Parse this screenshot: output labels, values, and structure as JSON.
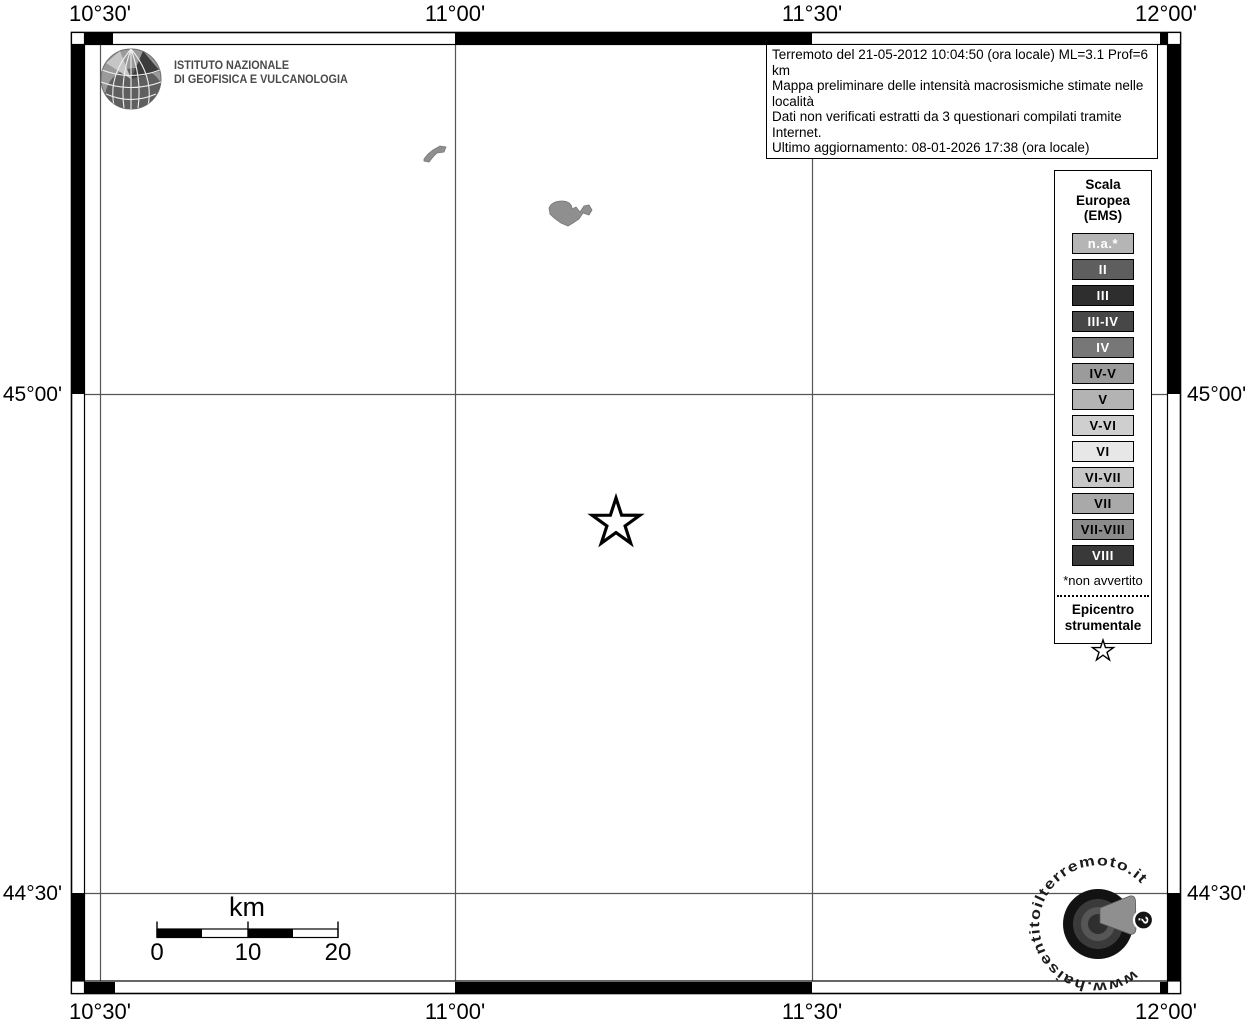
{
  "frame": {
    "top_labels": [
      "10°30'",
      "11°00'",
      "11°30'",
      "12°00'"
    ],
    "bottom_labels": [
      "10°30'",
      "11°00'",
      "11°30'",
      "12°00'"
    ],
    "left_labels": [
      "45°00'",
      "44°30'"
    ],
    "right_labels": [
      "45°00'",
      "44°30'"
    ]
  },
  "header": {
    "ingv_line1": "ISTITUTO NAZIONALE",
    "ingv_line2": "DI GEOFISICA E VULCANOLOGIA"
  },
  "info_box": {
    "line1": "Terremoto del 21-05-2012 10:04:50 (ora locale) ML=3.1 Prof=6 km",
    "line2": "Mappa preliminare delle intensità macrosismiche stimate nelle località",
    "line3": "Dati non verificati estratti da 3 questionari compilati tramite Internet.",
    "line4": "Ultimo aggiornamento: 08-01-2026 17:38 (ora locale)"
  },
  "legend": {
    "title_line1": "Scala",
    "title_line2": "Europea",
    "title_line3": "(EMS)",
    "items": [
      {
        "label": "n.a.*",
        "bg": "#b5b5b5",
        "fg": "#ffffff"
      },
      {
        "label": "II",
        "bg": "#5e5e5e",
        "fg": "#ffffff"
      },
      {
        "label": "III",
        "bg": "#2e2e2e",
        "fg": "#ffffff"
      },
      {
        "label": "III-IV",
        "bg": "#474747",
        "fg": "#ffffff"
      },
      {
        "label": "IV",
        "bg": "#777777",
        "fg": "#ffffff"
      },
      {
        "label": "IV-V",
        "bg": "#9b9b9b",
        "fg": "#000000"
      },
      {
        "label": "V",
        "bg": "#b3b3b3",
        "fg": "#000000"
      },
      {
        "label": "V-VI",
        "bg": "#cfcfcf",
        "fg": "#000000"
      },
      {
        "label": "VI",
        "bg": "#e7e7e7",
        "fg": "#000000"
      },
      {
        "label": "VI-VII",
        "bg": "#c7c7c7",
        "fg": "#000000"
      },
      {
        "label": "VII",
        "bg": "#a9a9a9",
        "fg": "#000000"
      },
      {
        "label": "VII-VIII",
        "bg": "#8b8b8b",
        "fg": "#000000"
      },
      {
        "label": "VIII",
        "bg": "#393939",
        "fg": "#ffffff"
      }
    ],
    "footnote": "*non avvertito",
    "epicenter_line1": "Epicentro",
    "epicenter_line2": "strumentale"
  },
  "scalebar": {
    "unit_label": "km",
    "tick_labels": [
      "0",
      "10",
      "20"
    ]
  },
  "watermark": {
    "site_text": "www.haisentitoilterremoto.it",
    "question_mark": "?"
  },
  "icons": {
    "epicenter": "star-outline",
    "legend_epicenter": "star-outline",
    "ingv_logo": "globe-wireframe",
    "watermark_logo": "seismograph-speaker-circle",
    "watermark_badge": "question-mark"
  },
  "colors": {
    "map_background": "#ffffff",
    "grid_line": "#555555",
    "frame_ink": "#000000",
    "lake_fill": "#8f8f8f",
    "ingv_text": "#4a4a4a"
  }
}
